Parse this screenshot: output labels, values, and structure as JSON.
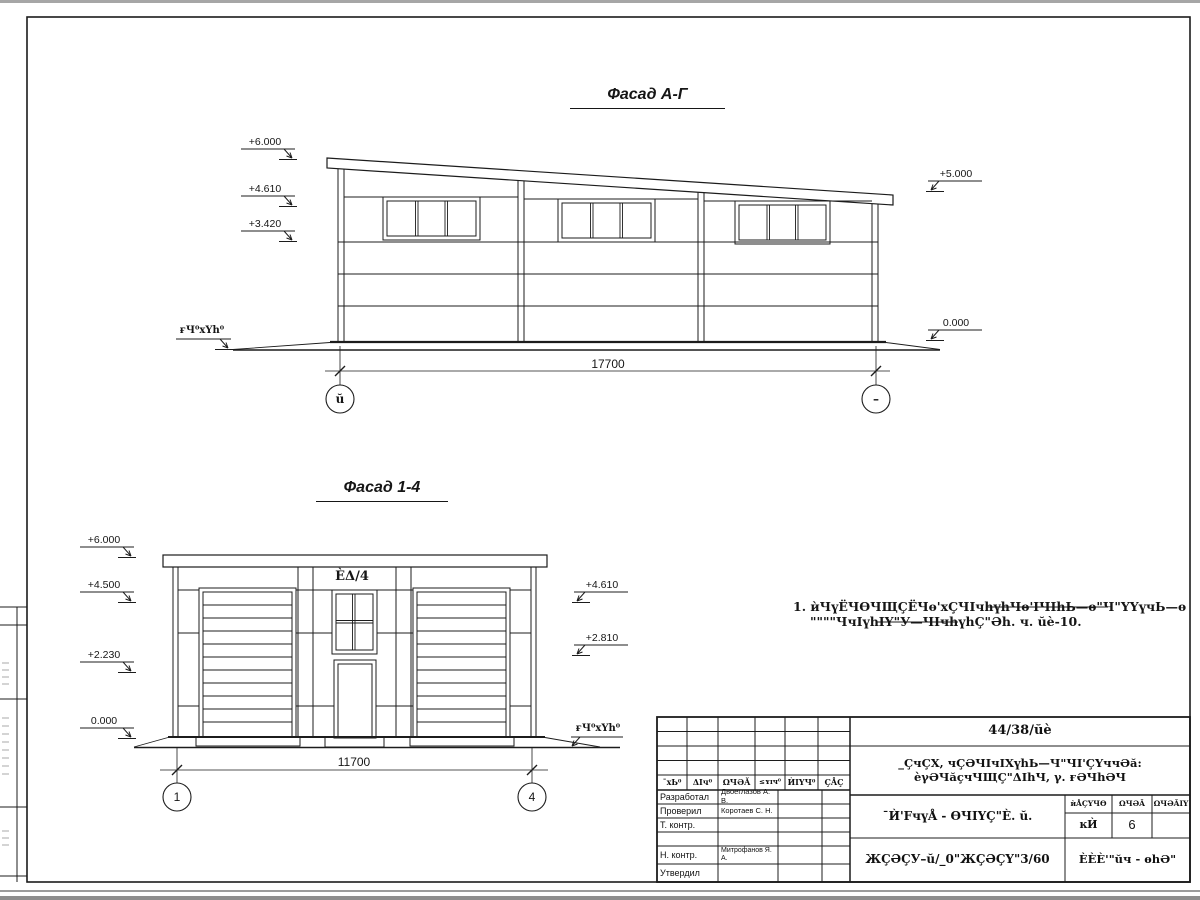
{
  "facade_top": {
    "title": "Фасад А-Г",
    "marks_left": [
      "+6.000",
      "+4.610",
      "+3.420"
    ],
    "marks_right": [
      "+5.000",
      "0.000"
    ],
    "ground_label": "ғЧ⁰хҮh⁰",
    "dimension": "17700",
    "axis_left": "ŭ",
    "axis_right": "–"
  },
  "facade_bottom": {
    "title": "Фасад 1-4",
    "marks_left": [
      "+6.000",
      "+4.500",
      "+2.230",
      "0.000"
    ],
    "marks_right": [
      "+4.610",
      "+2.810"
    ],
    "ground_label": "ғЧ⁰хҮh⁰",
    "door_label": "ÈΔ/4",
    "dimension": "11700",
    "axis_left": "1",
    "axis_right": "4"
  },
  "note": {
    "line1": "1. ѝЧүЁЧѲЧЩÇЁЧѳ'хÇЧІчhүhЧѳ'ІЧІhЬ—ѳ\"Ч\"ҮҮүчЬ—ѳ",
    "line2": "\"\"\"\"ЧчІүhІҮ\"У—ЧІчhүhÇ\"Әh. ч. ŭè-10."
  },
  "title_block": {
    "doc_number": "44/38/ŭè",
    "project_line1": "_ÇчÇХ, чÇӘЧІчІХүhЬ—Ч\"ЧІ'ÇҮччӘă:",
    "project_line2": "èγӘЧăçчЧЩÇ\"ΔІhЧ, γ. ғӘЧhӘЧ",
    "rev_headers": [
      "¯хЬ⁰",
      "ΔІч⁰",
      "ΩЧӘĂ",
      "≤ʏɪч⁰",
      "ЍІҮЧ⁰",
      "ÇÅÇ"
    ],
    "rows": [
      {
        "role": "Разработал",
        "name": "Двоеглазов А. В."
      },
      {
        "role": "Проверил",
        "name": "Коротаев С. Н."
      },
      {
        "role": "Т. контр.",
        "name": ""
      },
      {
        "role": "Н. контр.",
        "name": "Митрофанов Я. А."
      },
      {
        "role": "Утвердил",
        "name": ""
      }
    ],
    "sheet_title": "¯Ѝ'FчүÅ - ѲЧІҮÇ\"È. ŭ.",
    "stage_headers": [
      "ѝÅÇҮЧѲ",
      "ΩЧӘĂ",
      "ΩЧӘĂІҮ"
    ],
    "stage": "ĸЍ",
    "sheet_num": "6",
    "sheets_total": "",
    "bottom_code": "ЖÇӘÇУ–ŭ/_0\"ЖÇӘÇҮ\"3/60",
    "company": "ÈÈÈ'\"ŭч - ѳhӘ\""
  }
}
